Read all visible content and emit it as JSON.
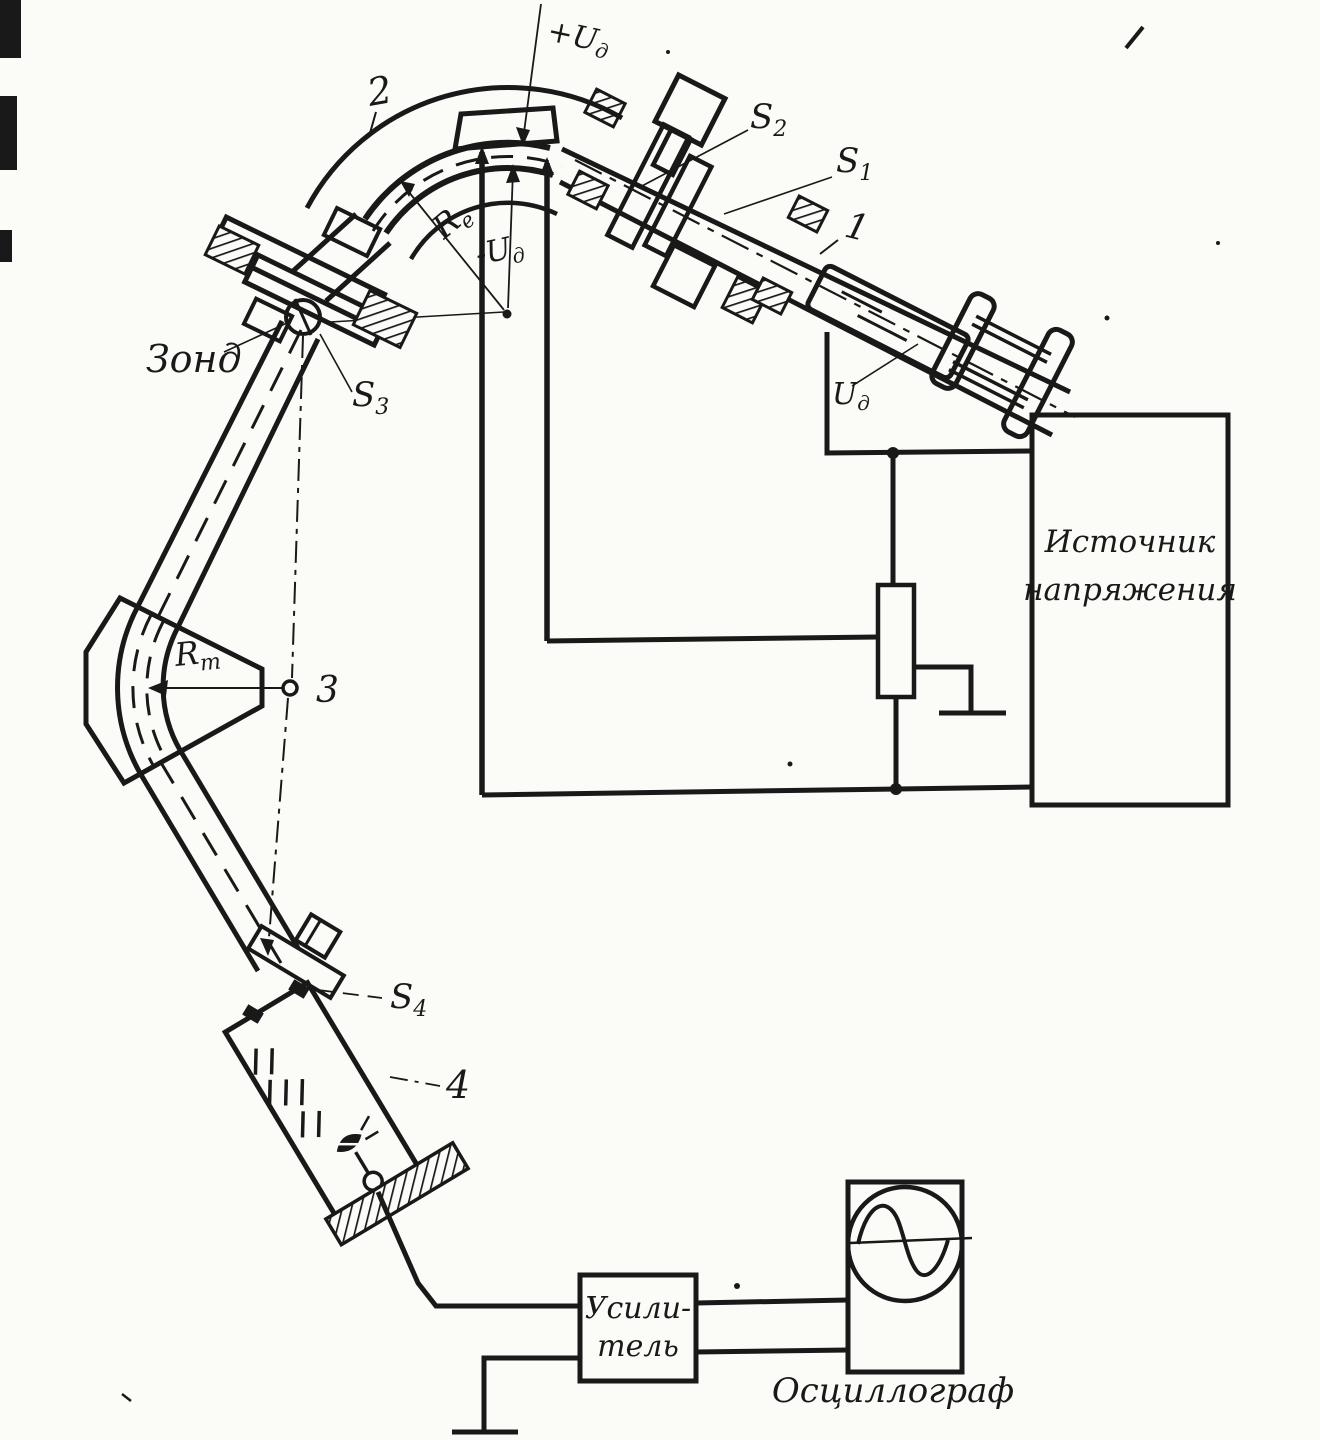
{
  "figure": {
    "type": "scanned-schematic",
    "description": "Mass-spectrometer / charged-particle energy analyzer schematic (Russian)",
    "colors": {
      "ink": "#191919",
      "paper": "#fbfbf8"
    }
  },
  "labels": {
    "plus_ud": {
      "base": "+U",
      "sub": "д"
    },
    "minus_ud": {
      "base": "-U",
      "sub": "д"
    },
    "ud_gun": {
      "base": "U",
      "sub": "д"
    },
    "re": {
      "base": "R",
      "sub": "e"
    },
    "rm": {
      "base": "R",
      "sub": "m"
    },
    "s1": {
      "base": "S",
      "sub": "1"
    },
    "s2": {
      "base": "S",
      "sub": "2"
    },
    "s3": {
      "base": "S",
      "sub": "3"
    },
    "s4": {
      "base": "S",
      "sub": "4"
    },
    "probe": "Зонд",
    "num1": "1",
    "num2": "2",
    "num3": "3",
    "num4": "4"
  },
  "blocks": {
    "voltage_source": {
      "line1": "Источник",
      "line2": "напряжения"
    },
    "amplifier": {
      "line1": "Усили-",
      "line2": "тель"
    },
    "oscilloscope": {
      "label": "Осциллограф"
    }
  }
}
